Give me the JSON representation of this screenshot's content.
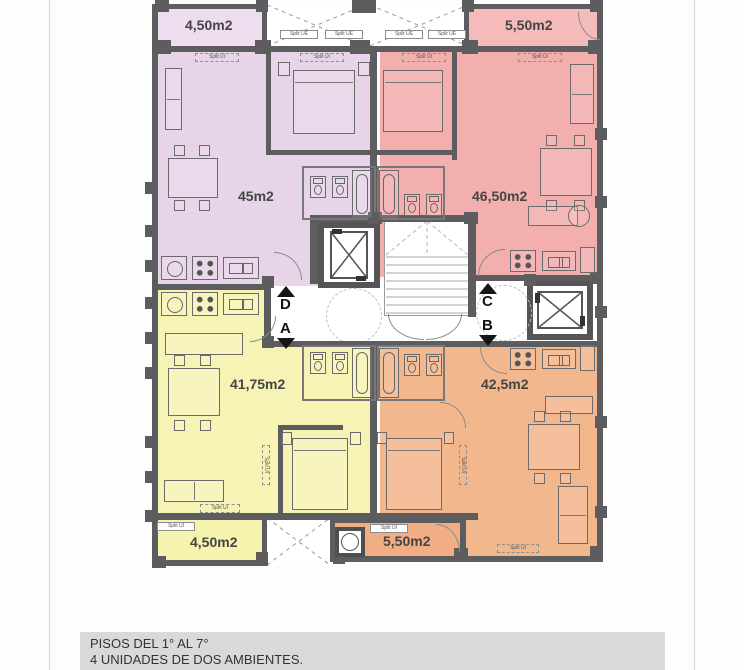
{
  "plan": {
    "units": {
      "purple": "45m2",
      "pink": "46,50m2",
      "yellow": "41,75m2",
      "orange": "42,5m2"
    },
    "balconies": {
      "top_left": "4,50m2",
      "top_right": "5,50m2",
      "bottom_left": "4,50m2",
      "bottom_right": "5,50m2"
    },
    "markers": [
      {
        "letter": "D",
        "dir": "up"
      },
      {
        "letter": "A",
        "dir": "down"
      },
      {
        "letter": "C",
        "dir": "up"
      },
      {
        "letter": "B",
        "dir": "down"
      }
    ],
    "tags": {
      "split_ui": "Split UI",
      "split_ue": "Split UE"
    },
    "colors": {
      "purple": "#e8d4e9",
      "purple_balcony": "#eedcef",
      "pink": "#f3aeae",
      "pink_balcony": "#f5baba",
      "yellow": "#f6f3b5",
      "yellow_balcony": "#f6f3ae",
      "orange": "#f3b78d",
      "orange_balcony": "#f1ad84",
      "wall": "#5d5c5e",
      "caption_bg": "#d9d9d9"
    }
  },
  "caption": {
    "line1": "PISOS DEL 1° AL 7°",
    "line2": "4 UNIDADES DE DOS AMBIENTES."
  }
}
